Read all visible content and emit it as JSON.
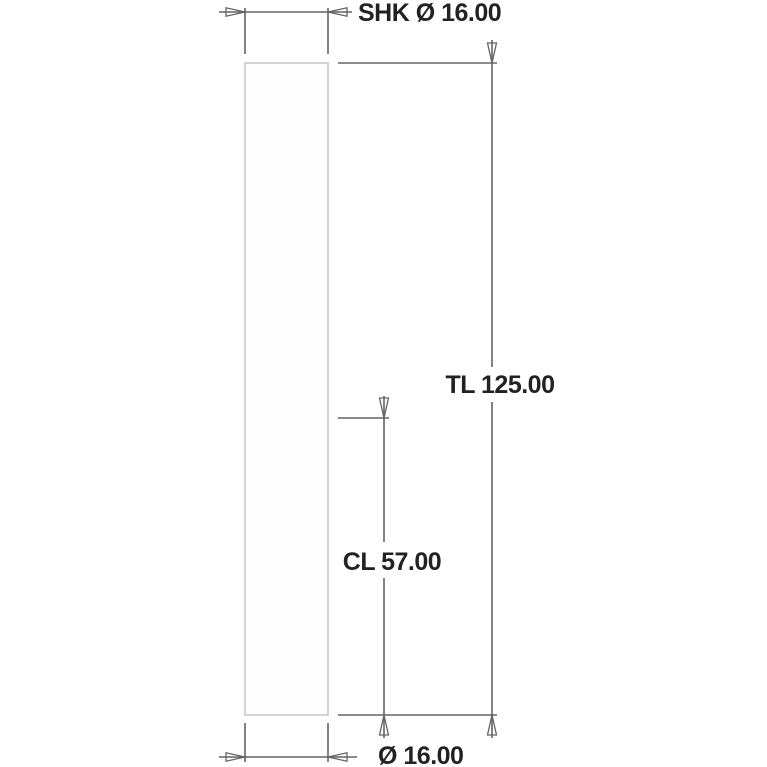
{
  "drawing": {
    "labels": {
      "shank_diameter": "SHK Ø 16.00",
      "total_length": "TL 125.00",
      "cut_length": "CL 57.00",
      "cut_diameter": "Ø 16.00"
    },
    "dimensions_mm": {
      "shank_diameter": 16.0,
      "total_length": 125.0,
      "cut_length": 57.0,
      "cut_diameter": 16.0
    },
    "colors": {
      "dimension_line": "#646464",
      "tool_outline": "#c9c9c9",
      "text": "#222222",
      "background": "#ffffff"
    }
  }
}
